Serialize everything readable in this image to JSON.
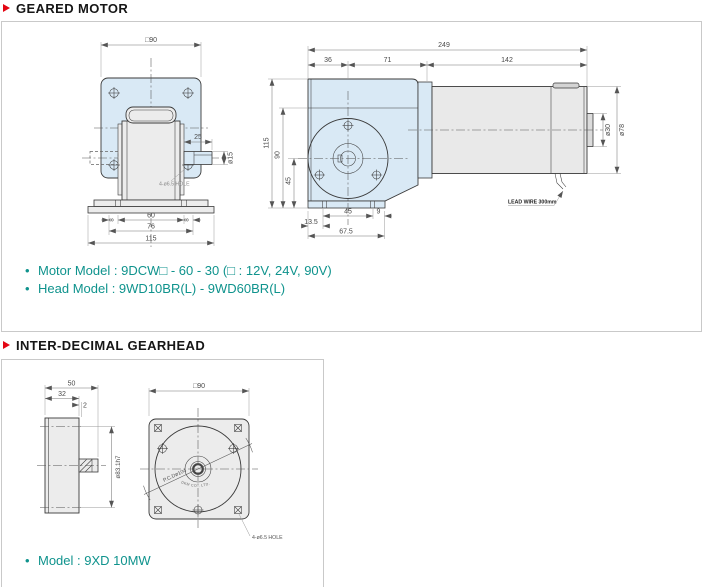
{
  "palette": {
    "accent_red": "#e30613",
    "teal": "#0f938d",
    "flange_blue": "#d9e9f5",
    "metal_gray": "#e9e9e9",
    "box_border": "#c9c9c9"
  },
  "geared_motor": {
    "title": "GEARED MOTOR",
    "notes": [
      "Motor Model : 9DCW□ - 60 - 30 (□ : 12V, 24V, 90V)",
      "Head Model : 9WD10BR(L) - 9WD60BR(L)"
    ],
    "front_view": {
      "dims": {
        "width_sq": "□90",
        "shaft_len": "25",
        "shaft_dia": "ø15",
        "hole": "4-ø6.5 HOLE",
        "base_8l": "8",
        "base_60": "60",
        "base_8r": "8",
        "base_76": "76",
        "base_115": "115"
      }
    },
    "side_view": {
      "dims": {
        "total": "249",
        "seg36": "36",
        "seg71": "71",
        "seg142": "142",
        "h115": "115",
        "h90": "90",
        "h45": "45",
        "d30": "ø30",
        "d78": "ø78",
        "b45": "45",
        "b9": "9",
        "b135": "13.5",
        "b675": "67.5"
      },
      "lead_wire": "LEAD WIRE 300mm"
    }
  },
  "inter_decimal_gearhead": {
    "title": "INTER-DECIMAL GEARHEAD",
    "note": "Model : 9XD 10MW",
    "side_view": {
      "dims": {
        "len50": "50",
        "len32": "32",
        "len2": "2",
        "spigot": "ø83.1h7"
      }
    },
    "front_view": {
      "dims": {
        "width_sq": "□90",
        "pcd": "P.C.Dø104",
        "hole": "4-ø6.5 HOLE"
      },
      "maker": "DKM CO., LTD."
    }
  }
}
